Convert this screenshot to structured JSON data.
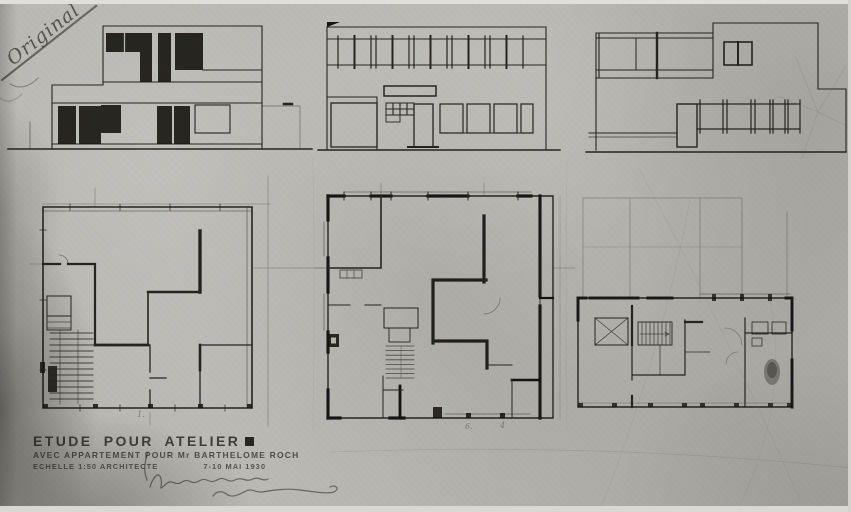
{
  "colors": {
    "paper": "#b5b4af",
    "ink": "#26241f",
    "pencil": "#55524c",
    "black_fill": "#17150f"
  },
  "handwriting": {
    "corner_note": "Original"
  },
  "title_block": {
    "line1": "ETUDE POUR ATELIER",
    "line2": "AVEC APPARTEMENT POUR Mr BARTHELOME ROCH",
    "scale": "ECHELLE 1:50 ARCHITECTE",
    "date": "7-10 MAI 1930"
  },
  "plan_marks": [
    {
      "text": "1."
    },
    {
      "text": "6."
    },
    {
      "text": "4"
    }
  ]
}
